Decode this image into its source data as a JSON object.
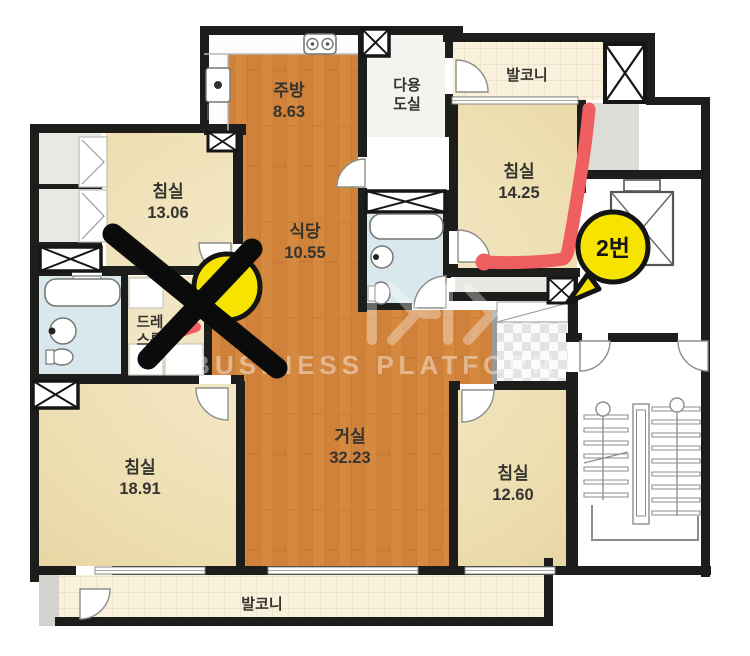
{
  "rooms": {
    "kitchen": {
      "label": "주방",
      "area": "8.63"
    },
    "bedroom_top_left": {
      "label": "침실",
      "area": "13.06"
    },
    "dining": {
      "label": "식당",
      "area": "10.55"
    },
    "utility": {
      "line1": "다용",
      "line2": "도실"
    },
    "balcony_top": {
      "label": "발코니"
    },
    "bedroom_top_right": {
      "label": "침실",
      "area": "14.25"
    },
    "dress_room": {
      "line1": "드레",
      "line2": "스룸"
    },
    "living": {
      "label": "거실",
      "area": "32.23"
    },
    "bedroom_bottom_left": {
      "label": "침실",
      "area": "18.91"
    },
    "bedroom_bottom_right": {
      "label": "침실",
      "area": "12.60"
    },
    "balcony_bottom": {
      "label": "발코니"
    }
  },
  "annotations": {
    "marker_2_label": "2번",
    "watermark_text": "BUSINESS PLATFORM"
  },
  "colors": {
    "wall": "#1d1d1b",
    "wood_floor": "#d0813a",
    "bedroom_floor": "#eedfb2",
    "balcony_floor": "#faf1dd",
    "bathroom_floor": "#d8e8ec",
    "annotation_red": "#ef5e60",
    "annotation_yellow": "#f7e300",
    "annotation_black": "#0b0b0b"
  }
}
